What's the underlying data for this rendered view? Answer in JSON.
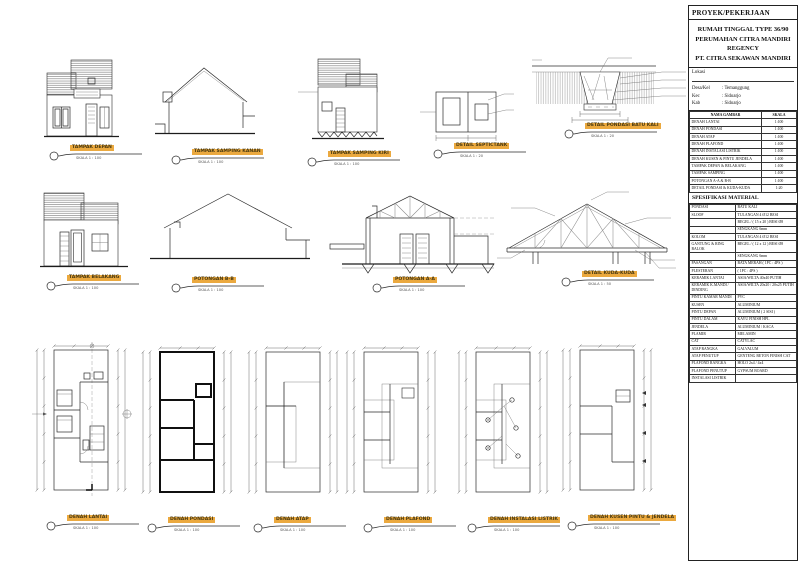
{
  "colors": {
    "highlight": "#eba93f",
    "line": "#2b2b2b",
    "paper": "#ffffff"
  },
  "title_block": {
    "header": "PROYEK/PEKERJAAN",
    "project_lines": [
      "RUMAH TINGGAL TYPE 36/90",
      "PERUMAHAN CITRA MANDIRI",
      "REGENCY",
      "PT. CITRA SEKAWAN MANDIRI"
    ],
    "lokasi_label": "Lokasi",
    "lokasi_fields": [
      {
        "label": "Desa/Kel",
        "value": ": Temanggung"
      },
      {
        "label": "Kec",
        "value": ": Sidoarjo"
      },
      {
        "label": "Kab",
        "value": ": Sidoarjo"
      }
    ],
    "drawing_list": {
      "headers": [
        "NAMA GAMBAR",
        "SKALA"
      ],
      "rows": [
        [
          "DENAH LANTAI",
          "1:100"
        ],
        [
          "DENAH PONDASI",
          "1:100"
        ],
        [
          "DENAH ATAP",
          "1:100"
        ],
        [
          "DENAH PLAFOND",
          "1:100"
        ],
        [
          "DENAH INSTALASI LISTRIK",
          "1:100"
        ],
        [
          "DENAH KUSEN & PINTU JENDELA",
          "1:100"
        ],
        [
          "TAMPAK DEPAN & BELAKANG",
          "1:100"
        ],
        [
          "TAMPAK SAMPING",
          "1:100"
        ],
        [
          "POTONGAN A-A & B-B",
          "1:100"
        ],
        [
          "DETAIL PONDASI & KUDA-KUDA",
          "1:20"
        ]
      ]
    },
    "spec_title": "SPESIFIKASI MATERIAL",
    "spec_rows": [
      [
        "PONDASI",
        "BATU KALI"
      ],
      [
        "SLOOF",
        "TULANGAN 4 Ø12 BESI"
      ],
      [
        "",
        "BEGEL / ( 15 x 20 ) BESI Ø8"
      ],
      [
        "",
        "SENGKANG 6mm"
      ],
      [
        "KOLOM",
        "TULANGAN 4 Ø12 BESI"
      ],
      [
        "GANTUNG & RING BALOK",
        "BEGEL / ( 12 x 12 ) BESI Ø8"
      ],
      [
        "",
        "SENGKANG 6mm"
      ],
      [
        "PASANGAN",
        "BATA MERAH ( 1PC : 4PS )"
      ],
      [
        "PLESTERAN",
        "( 1PC : 4PS )"
      ],
      [
        "KERAMIK LANTAI",
        "ASIA/WILTA 40x40 PUTIH"
      ],
      [
        "KERAMIK K.MANDI / DINDING",
        "ASIA/WILTA 20x20 / 20x25 PUTIH"
      ],
      [
        "PINTU KAMAR MANDI",
        "PVC"
      ],
      [
        "KUSEN",
        "ALUMINIUM"
      ],
      [
        "PINTU DEPAN",
        "ALUMINIUM ( 2 SISI )"
      ],
      [
        "PINTU DALAM",
        "KAYU FINISH HPL"
      ],
      [
        "JENDELA",
        "ALUMINIUM / KACA"
      ],
      [
        "PLAMIR",
        "MELAMIN"
      ],
      [
        "CAT",
        "CATYLAC"
      ],
      [
        "ATAP RANGKA",
        "GALVALUM"
      ],
      [
        "ATAP PENUTUP",
        "GENTENG BETON FINISH CAT"
      ],
      [
        "PLAFOND RANGKA",
        "HOLO 2x4 / 4x4"
      ],
      [
        "PLAFOND PENUTUP",
        "GYPSUM BOARD"
      ],
      [
        "INSTALASI LISTRIK",
        ""
      ]
    ]
  },
  "drawings": [
    {
      "title": "TAMPAK DEPAN",
      "scale": "SKALA 1 : 100"
    },
    {
      "title": "TAMPAK SAMPING KANAN",
      "scale": "SKALA 1 : 100"
    },
    {
      "title": "TAMPAK SAMPING KIRI",
      "scale": "SKALA 1 : 100"
    },
    {
      "title": "DETAIL SEPTICTANK",
      "scale": "SKALA 1 : 20"
    },
    {
      "title": "DETAIL PONDASI BATU KALI",
      "scale": "SKALA 1 : 20"
    },
    {
      "title": "TAMPAK BELAKANG",
      "scale": "SKALA 1 : 100"
    },
    {
      "title": "POTONGAN B-B",
      "scale": "SKALA 1 : 100"
    },
    {
      "title": "POTONGAN A-A",
      "scale": "SKALA 1 : 100"
    },
    {
      "title": "DETAIL KUDA-KUDA",
      "scale": "SKALA 1 : 50"
    },
    {
      "title": "DENAH LANTAI",
      "scale": "SKALA 1 : 100"
    },
    {
      "title": "DENAH PONDASI",
      "scale": "SKALA 1 : 100"
    },
    {
      "title": "DENAH ATAP",
      "scale": "SKALA 1 : 100"
    },
    {
      "title": "DENAH PLAFOND",
      "scale": "SKALA 1 : 100"
    },
    {
      "title": "DENAH INSTALASI LISTRIK",
      "scale": "SKALA 1 : 100"
    },
    {
      "title": "DENAH KUSEN PINTU & JENDELA",
      "scale": "SKALA 1 : 100"
    }
  ]
}
